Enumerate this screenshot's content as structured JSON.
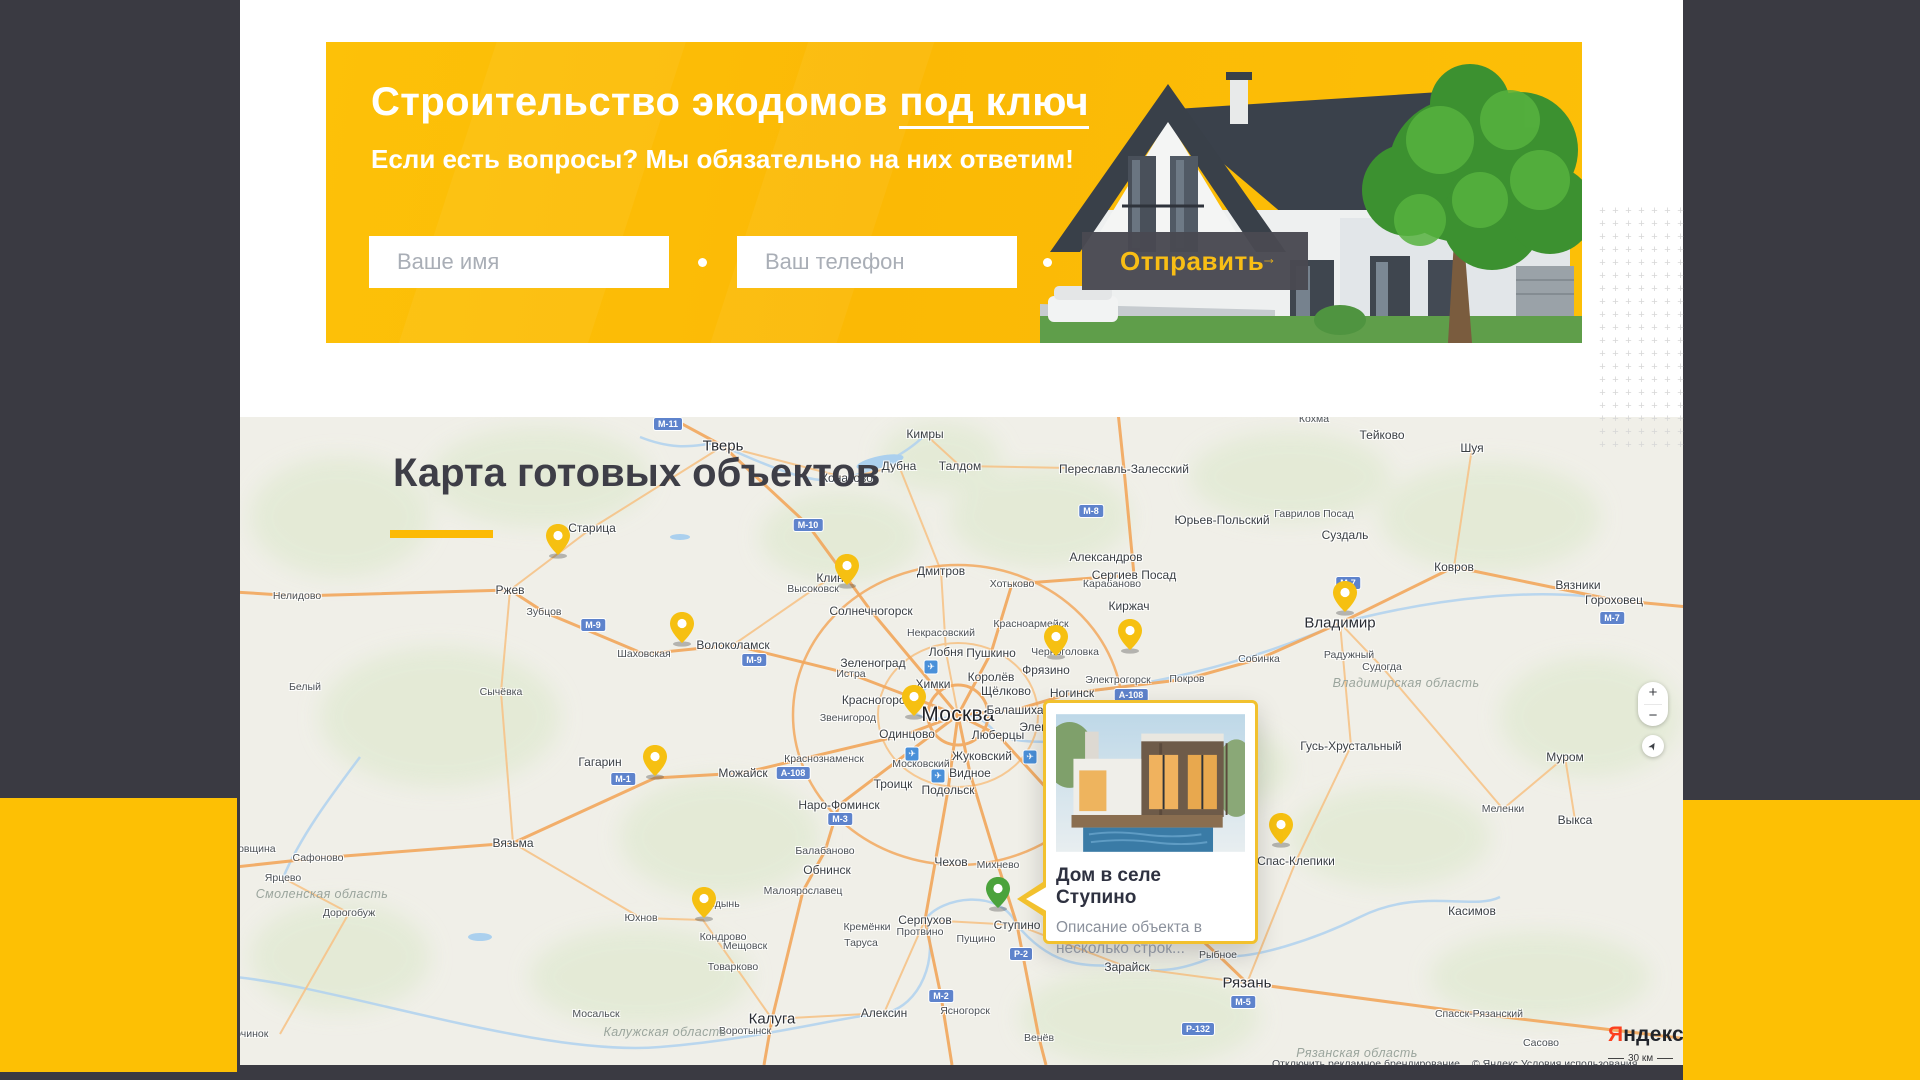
{
  "banner": {
    "title_main": "Строительство экодомов ",
    "title_underlined": "под ключ",
    "subtitle": "Если есть вопросы? Мы обязательно на них ответим!",
    "name_placeholder": "Ваше имя",
    "phone_placeholder": "Ваш телефон",
    "submit_label": "Отправить",
    "colors": {
      "banner_bg": "#fbba05",
      "accent_yellow": "#fdc004",
      "button_bg": "#494952",
      "button_text": "#f9be15",
      "dark_bg": "#3a3a42"
    }
  },
  "map": {
    "title": "Карта готовых объектов",
    "popup": {
      "title": "Дом в селе Ступино",
      "description": "Описание объекта в несколько строк...",
      "border_color": "#f2c12e"
    },
    "controls": {
      "zoom_in": "+",
      "zoom_out": "−",
      "geolocate_icon": "➤"
    },
    "brand": {
      "part1": "Я",
      "part2": "ндекс"
    },
    "scale_label": "30 км",
    "attribution_left": "Отключить рекламное брендирование",
    "attribution_right": "© Яндекс Условия использования",
    "pins": {
      "yellow": [
        [
          318,
          140
        ],
        [
          607,
          170
        ],
        [
          442,
          228
        ],
        [
          816,
          241
        ],
        [
          890,
          235
        ],
        [
          674,
          301
        ],
        [
          1105,
          197
        ],
        [
          415,
          361
        ],
        [
          464,
          503
        ],
        [
          1041,
          429
        ]
      ],
      "green": [
        758,
        493
      ]
    },
    "cities": [
      [
        "Москва",
        718,
        298,
        "xl"
      ],
      [
        "Тверь",
        483,
        29,
        "l"
      ],
      [
        "Владимир",
        1100,
        206,
        "l"
      ],
      [
        "Рязань",
        1007,
        566,
        "l"
      ],
      [
        "Калуга",
        532,
        602,
        "l"
      ],
      [
        "Кимры",
        685,
        17,
        "m"
      ],
      [
        "Дубна",
        659,
        49,
        "m"
      ],
      [
        "Талдом",
        720,
        49,
        "m"
      ],
      [
        "Конаково",
        607,
        61,
        "m"
      ],
      [
        "Тейково",
        1142,
        18,
        "m"
      ],
      [
        "Кохма",
        1074,
        2,
        "s"
      ],
      [
        "Шуя",
        1232,
        31,
        "m"
      ],
      [
        "Ковров",
        1214,
        150,
        "m"
      ],
      [
        "Вязники",
        1338,
        168,
        "m"
      ],
      [
        "Гороховец",
        1374,
        183,
        "m"
      ],
      [
        "Суздаль",
        1105,
        118,
        "m"
      ],
      [
        "Юрьев-Польский",
        982,
        103,
        "m"
      ],
      [
        "Переславль-Залесский",
        884,
        52,
        "m"
      ],
      [
        "Александров",
        866,
        140,
        "m"
      ],
      [
        "Карабаново",
        872,
        167,
        "s"
      ],
      [
        "Сергиев Посад",
        894,
        158,
        "m"
      ],
      [
        "Хотьково",
        772,
        167,
        "s"
      ],
      [
        "Гаврилов Посад",
        1074,
        97,
        "s"
      ],
      [
        "Дмитров",
        701,
        154,
        "m"
      ],
      [
        "Красноармейск",
        791,
        207,
        "s"
      ],
      [
        "Киржач",
        889,
        189,
        "m"
      ],
      [
        "Клин",
        590,
        161,
        "m"
      ],
      [
        "Высоковск",
        573,
        172,
        "s"
      ],
      [
        "Солнечногорск",
        631,
        194,
        "m"
      ],
      [
        "Некрасовский",
        701,
        216,
        "s"
      ],
      [
        "Лобня",
        706,
        235,
        "m"
      ],
      [
        "Пушкино",
        751,
        236,
        "m"
      ],
      [
        "Зеленоград",
        633,
        246,
        "m"
      ],
      [
        "Истра",
        611,
        257,
        "s"
      ],
      [
        "Химки",
        693,
        267,
        "m"
      ],
      [
        "Королёв",
        751,
        260,
        "m"
      ],
      [
        "Щёлково",
        766,
        274,
        "m"
      ],
      [
        "Фрязино",
        806,
        253,
        "m"
      ],
      [
        "Черноголовка",
        825,
        235,
        "s"
      ],
      [
        "Ногинск",
        832,
        276,
        "m"
      ],
      [
        "Электрогорск",
        878,
        263,
        "s"
      ],
      [
        "Покров",
        947,
        262,
        "s"
      ],
      [
        "Красногорск",
        636,
        283,
        "m"
      ],
      [
        "Балашиха",
        775,
        293,
        "m"
      ],
      [
        "Электросталь",
        818,
        310,
        "m"
      ],
      [
        "Звенигород",
        608,
        301,
        "s"
      ],
      [
        "Одинцово",
        667,
        317,
        "m"
      ],
      [
        "Люберцы",
        758,
        318,
        "m"
      ],
      [
        "Жуковский",
        742,
        339,
        "m"
      ],
      [
        "Московский",
        681,
        347,
        "s"
      ],
      [
        "Видное",
        730,
        356,
        "m"
      ],
      [
        "Краснознаменск",
        584,
        342,
        "s"
      ],
      [
        "Подольск",
        708,
        373,
        "m"
      ],
      [
        "Троицк",
        653,
        367,
        "m"
      ],
      [
        "Наро-Фоминск",
        599,
        388,
        "m"
      ],
      [
        "Старица",
        352,
        111,
        "m"
      ],
      [
        "Ржев",
        270,
        173,
        "m"
      ],
      [
        "Зубцов",
        304,
        195,
        "s"
      ],
      [
        "Нелидово",
        57,
        179,
        "s"
      ],
      [
        "Белый",
        65,
        270,
        "s"
      ],
      [
        "Сычёвка",
        261,
        275,
        "s"
      ],
      [
        "Шаховская",
        404,
        237,
        "s"
      ],
      [
        "Волоколамск",
        493,
        228,
        "m"
      ],
      [
        "Гагарин",
        360,
        345,
        "m"
      ],
      [
        "Можайск",
        503,
        356,
        "m"
      ],
      [
        "Вязьма",
        273,
        426,
        "m"
      ],
      [
        "Сафоново",
        78,
        441,
        "s"
      ],
      [
        "Ярцево",
        43,
        461,
        "s"
      ],
      [
        "Духовщина",
        8,
        432,
        "s"
      ],
      [
        "Дорогобуж",
        109,
        496,
        "s"
      ],
      [
        "Починок",
        8,
        617,
        "s"
      ],
      [
        "Мещовск",
        505,
        529,
        "s"
      ],
      [
        "Мосальск",
        356,
        597,
        "s"
      ],
      [
        "Юхнов",
        401,
        501,
        "s"
      ],
      [
        "Медынь",
        480,
        487,
        "s"
      ],
      [
        "Кондрово",
        483,
        520,
        "s"
      ],
      [
        "Товарково",
        493,
        550,
        "s"
      ],
      [
        "Воротынск",
        505,
        614,
        "s"
      ],
      [
        "Алексин",
        644,
        596,
        "m"
      ],
      [
        "Таруса",
        621,
        526,
        "s"
      ],
      [
        "Серпухов",
        685,
        503,
        "m"
      ],
      [
        "Протвино",
        680,
        515,
        "s"
      ],
      [
        "Кремёнки",
        627,
        510,
        "s"
      ],
      [
        "Пущино",
        736,
        522,
        "s"
      ],
      [
        "Чехов",
        711,
        445,
        "m"
      ],
      [
        "Обнинск",
        587,
        453,
        "m"
      ],
      [
        "Малоярославец",
        563,
        474,
        "s"
      ],
      [
        "Балабаново",
        585,
        434,
        "s"
      ],
      [
        "Михнево",
        758,
        448,
        "s"
      ],
      [
        "Ступино",
        777,
        508,
        "m"
      ],
      [
        "Венёв",
        799,
        621,
        "s"
      ],
      [
        "Ясногорск",
        725,
        594,
        "s"
      ],
      [
        "Собинка",
        1019,
        242,
        "s"
      ],
      [
        "Радужный",
        1109,
        238,
        "s"
      ],
      [
        "Судогда",
        1142,
        250,
        "s"
      ],
      [
        "Гусь-Хрустальный",
        1111,
        329,
        "m"
      ],
      [
        "Муром",
        1325,
        340,
        "m"
      ],
      [
        "Меленки",
        1263,
        392,
        "s"
      ],
      [
        "Выкса",
        1335,
        403,
        "m"
      ],
      [
        "Касимов",
        1232,
        494,
        "m"
      ],
      [
        "Спас-Клепики",
        1056,
        444,
        "m"
      ],
      [
        "Рыбное",
        978,
        538,
        "s"
      ],
      [
        "Зарайск",
        887,
        550,
        "m"
      ],
      [
        "Спасск-Рязанский",
        1239,
        597,
        "s"
      ],
      [
        "Сасово",
        1301,
        626,
        "s"
      ]
    ],
    "regions": [
      [
        "Смоленская область",
        82,
        477
      ],
      [
        "Калужская область",
        425,
        615
      ],
      [
        "Владимирская область",
        1166,
        266
      ],
      [
        "Рязанская область",
        1117,
        636
      ]
    ],
    "road_badges": [
      [
        "М-10",
        568,
        108
      ],
      [
        "М-11",
        428,
        7
      ],
      [
        "М-9",
        353,
        208
      ],
      [
        "М-9",
        514,
        243
      ],
      [
        "М-8",
        851,
        94
      ],
      [
        "М-7",
        1108,
        166
      ],
      [
        "М-7",
        1372,
        201
      ],
      [
        "А-108",
        891,
        278
      ],
      [
        "А-108",
        553,
        356
      ],
      [
        "М-1",
        383,
        362
      ],
      [
        "М-2",
        701,
        579
      ],
      [
        "М-5",
        1003,
        585
      ],
      [
        "Р-132",
        958,
        612
      ],
      [
        "Р-2",
        781,
        537
      ],
      [
        "М-3",
        600,
        402
      ]
    ],
    "airports": [
      [
        691,
        250
      ],
      [
        672,
        337
      ],
      [
        790,
        340
      ],
      [
        698,
        359
      ]
    ]
  }
}
